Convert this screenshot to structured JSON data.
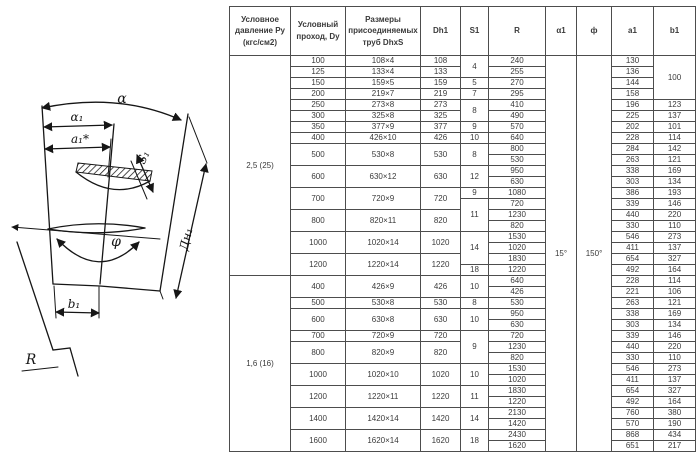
{
  "diagram": {
    "labels": {
      "alpha": "α",
      "alpha1": "α₁",
      "a1_star": "a₁*",
      "s1": "S₁",
      "dn1": "Дн₁",
      "phi": "φ",
      "b1": "b₁",
      "r": "R"
    }
  },
  "table": {
    "headers": [
      "Условное давление Ру (кгс/см2)",
      "Условный проход, Dy",
      "Размеры присоединяемых труб DhxS",
      "Dh1",
      "S1",
      "R",
      "α1",
      "ф",
      "a1",
      "b1"
    ],
    "col_widths": [
      61,
      55,
      75,
      40,
      28,
      57,
      31,
      35,
      42,
      42
    ],
    "angle_alpha1": "15°",
    "angle_phi": "150°",
    "sections": [
      "2,5 (25)",
      "1,6 (16)"
    ],
    "rows": [
      [
        [
          "2,5 (25)",
          20
        ],
        "100",
        "108×4",
        "108",
        [
          "4",
          2
        ],
        "240",
        [
          "15°",
          36
        ],
        [
          "150°",
          36
        ],
        "130",
        [
          "100",
          4
        ]
      ],
      [
        "125",
        "133×4",
        "133",
        "255",
        "136"
      ],
      [
        "150",
        "159×5",
        "159",
        "5",
        "270",
        "144"
      ],
      [
        "200",
        "219×7",
        "219",
        "7",
        "295",
        "158"
      ],
      [
        "250",
        "273×8",
        "273",
        [
          "8",
          2
        ],
        "410",
        "196",
        "123"
      ],
      [
        "300",
        "325×8",
        "325",
        "490",
        "225",
        "137"
      ],
      [
        "350",
        "377×9",
        "377",
        "9",
        "570",
        "202",
        "101"
      ],
      [
        "400",
        "426×10",
        "426",
        "10",
        "640",
        "228",
        "114"
      ],
      [
        [
          "500",
          2
        ],
        [
          "530×8",
          2
        ],
        [
          "530",
          2
        ],
        [
          "8",
          2
        ],
        "800",
        "284",
        "142"
      ],
      [
        "530",
        "263",
        "121"
      ],
      [
        [
          "600",
          2
        ],
        [
          "630×12",
          2
        ],
        [
          "630",
          2
        ],
        [
          "12",
          2
        ],
        "950",
        "338",
        "169"
      ],
      [
        "630",
        "303",
        "134"
      ],
      [
        [
          "700",
          2
        ],
        [
          "720×9",
          2
        ],
        [
          "720",
          2
        ],
        "9",
        "1080",
        "386",
        "193"
      ],
      [
        [
          "11",
          3
        ],
        "720",
        "339",
        "146"
      ],
      [
        [
          "800",
          2
        ],
        [
          "820×11",
          2
        ],
        [
          "820",
          2
        ],
        "1230",
        "440",
        "220"
      ],
      [
        "820",
        "330",
        "110"
      ],
      [
        [
          "1000",
          2
        ],
        [
          "1020×14",
          2
        ],
        [
          "1020",
          2
        ],
        [
          "14",
          3
        ],
        "1530",
        "546",
        "273"
      ],
      [
        "1020",
        "411",
        "137"
      ],
      [
        [
          "1200",
          2
        ],
        [
          "1220×14",
          2
        ],
        [
          "1220",
          2
        ],
        "1830",
        "654",
        "327"
      ],
      [
        "18",
        "1220",
        "492",
        "164"
      ],
      [
        [
          "1,6 (16)",
          16
        ],
        [
          "400",
          2
        ],
        [
          "426×9",
          2
        ],
        [
          "426",
          2
        ],
        [
          "10",
          2
        ],
        "640",
        "228",
        "114"
      ],
      [
        "426",
        "221",
        "106"
      ],
      [
        "500",
        "530×8",
        "530",
        "8",
        "530",
        "263",
        "121"
      ],
      [
        [
          "600",
          2
        ],
        [
          "630×8",
          2
        ],
        [
          "630",
          2
        ],
        [
          "10",
          2
        ],
        "950",
        "338",
        "169"
      ],
      [
        "630",
        "303",
        "134"
      ],
      [
        "700",
        "720×9",
        "720",
        [
          "9",
          3
        ],
        "720",
        "339",
        "146"
      ],
      [
        [
          "800",
          2
        ],
        [
          "820×9",
          2
        ],
        [
          "820",
          2
        ],
        "1230",
        "440",
        "220"
      ],
      [
        "820",
        "330",
        "110"
      ],
      [
        [
          "1000",
          2
        ],
        [
          "1020×10",
          2
        ],
        [
          "1020",
          2
        ],
        [
          "10",
          2
        ],
        "1530",
        "546",
        "273"
      ],
      [
        "1020",
        "411",
        "137"
      ],
      [
        [
          "1200",
          2
        ],
        [
          "1220×11",
          2
        ],
        [
          "1220",
          2
        ],
        [
          "11",
          2
        ],
        "1830",
        "654",
        "327"
      ],
      [
        "1220",
        "492",
        "164"
      ],
      [
        [
          "1400",
          2
        ],
        [
          "1420×14",
          2
        ],
        [
          "1420",
          2
        ],
        [
          "14",
          2
        ],
        "2130",
        "760",
        "380"
      ],
      [
        "1420",
        "570",
        "190"
      ],
      [
        [
          "1600",
          2
        ],
        [
          "1620×14",
          2
        ],
        [
          "1620",
          2
        ],
        [
          "18",
          2
        ],
        "2430",
        "868",
        "434"
      ],
      [
        "1620",
        "651",
        "217"
      ]
    ]
  },
  "colors": {
    "ink": "#161616",
    "table_border": "#4d4d4d",
    "text": "#3a3a3a",
    "paper": "#ffffff"
  }
}
